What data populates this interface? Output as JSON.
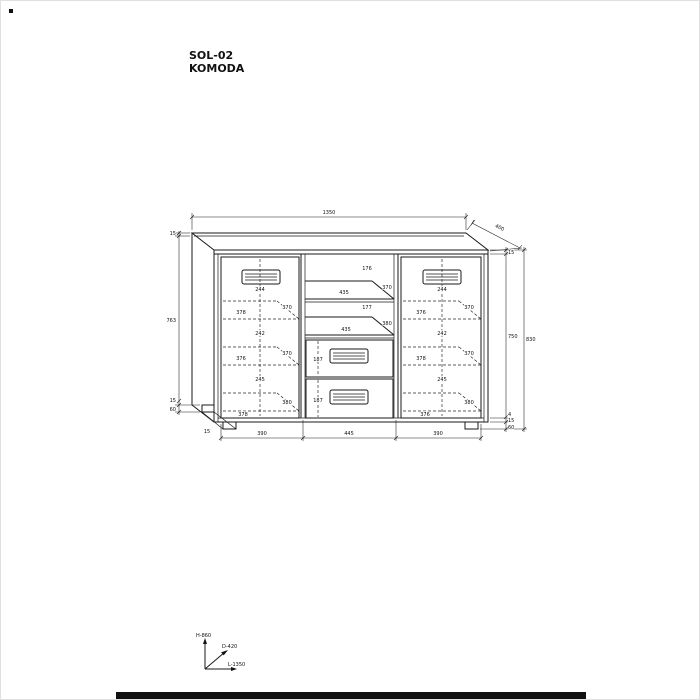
{
  "title": {
    "model": "SOL-02",
    "product": "KOMODA"
  },
  "axis_legend": {
    "height": "H-860",
    "depth": "D-420",
    "length": "L-1350"
  },
  "overall": {
    "top_width": "1350",
    "top_depth": "400"
  },
  "left_chain": {
    "top_thickness": "15",
    "body_height": "763",
    "bottom_panel": "15",
    "leg_height": "60"
  },
  "right_chain": {
    "top_thickness": "15",
    "interior_height": "750",
    "gap": "4",
    "bottom_panel": "15",
    "leg_height": "60",
    "overall_height": "830"
  },
  "bottom_chain": {
    "left": "390",
    "middle": "445",
    "right": "390"
  },
  "leg_label": "15",
  "left_door": {
    "heights": [
      "244",
      "242",
      "245"
    ],
    "widths": [
      "378",
      "376",
      "378"
    ],
    "depths": [
      "370",
      "370",
      "380"
    ]
  },
  "right_door": {
    "heights": [
      "244",
      "242",
      "245"
    ],
    "widths": [
      "376",
      "378",
      "376"
    ],
    "depths": [
      "370",
      "370",
      "380"
    ]
  },
  "middle_section": {
    "compartment_heights": [
      "176",
      "177"
    ],
    "shelf_widths": [
      "435",
      "435"
    ],
    "shelf_depths": [
      "370",
      "380"
    ],
    "drawer_heights": [
      "187",
      "187"
    ]
  }
}
